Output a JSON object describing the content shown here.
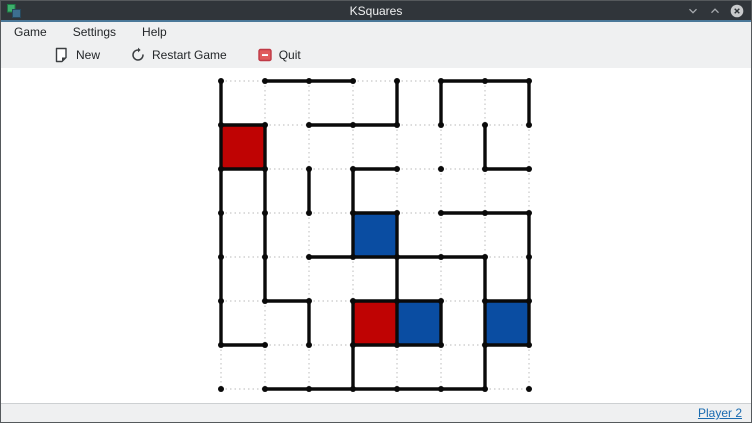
{
  "window": {
    "title": "KSquares"
  },
  "menu_bar": {
    "items": [
      {
        "label": "Game"
      },
      {
        "label": "Settings"
      },
      {
        "label": "Help"
      }
    ]
  },
  "toolbar": {
    "buttons": [
      {
        "label": "New",
        "icon": "new-document-icon"
      },
      {
        "label": "Restart Game",
        "icon": "restart-icon"
      },
      {
        "label": "Quit",
        "icon": "quit-icon"
      }
    ]
  },
  "status_bar": {
    "current_player_label": "Player 2",
    "text_color": "#1a6bb0"
  },
  "board": {
    "cols": 7,
    "rows": 7,
    "dot_grid": [
      8,
      8
    ],
    "origin": [
      8,
      8
    ],
    "spacing": 44,
    "dot_radius": 3,
    "line_width": 3.4,
    "line_color": "#0a0a0a",
    "dashed_color": "#c8c8c8",
    "player_colors": {
      "1": "#bf0303",
      "2": "#0a4da2"
    },
    "horizontal_edges": [
      [
        0,
        1,
        1,
        0,
        0,
        1,
        1
      ],
      [
        1,
        0,
        1,
        1,
        0,
        0,
        0
      ],
      [
        1,
        0,
        0,
        1,
        0,
        0,
        1
      ],
      [
        0,
        0,
        0,
        1,
        0,
        1,
        1
      ],
      [
        0,
        0,
        1,
        1,
        1,
        1,
        0
      ],
      [
        0,
        1,
        0,
        1,
        1,
        0,
        1
      ],
      [
        1,
        0,
        0,
        1,
        1,
        0,
        1
      ],
      [
        0,
        1,
        1,
        1,
        1,
        1,
        0
      ]
    ],
    "vertical_edges_by_col": [
      [
        1,
        1,
        1,
        1,
        1,
        1,
        0
      ],
      [
        0,
        1,
        1,
        1,
        1,
        0,
        0
      ],
      [
        0,
        0,
        1,
        0,
        0,
        1,
        0
      ],
      [
        0,
        0,
        1,
        1,
        0,
        1,
        1
      ],
      [
        1,
        0,
        0,
        1,
        1,
        1,
        0
      ],
      [
        1,
        0,
        0,
        0,
        0,
        1,
        0
      ],
      [
        0,
        1,
        0,
        0,
        1,
        1,
        1
      ],
      [
        1,
        0,
        0,
        1,
        1,
        1,
        0
      ]
    ],
    "filled_cells": [
      {
        "col": 0,
        "row": 1,
        "player": "1"
      },
      {
        "col": 3,
        "row": 3,
        "player": "2"
      },
      {
        "col": 3,
        "row": 5,
        "player": "1"
      },
      {
        "col": 4,
        "row": 5,
        "player": "2"
      },
      {
        "col": 6,
        "row": 5,
        "player": "2"
      }
    ]
  }
}
